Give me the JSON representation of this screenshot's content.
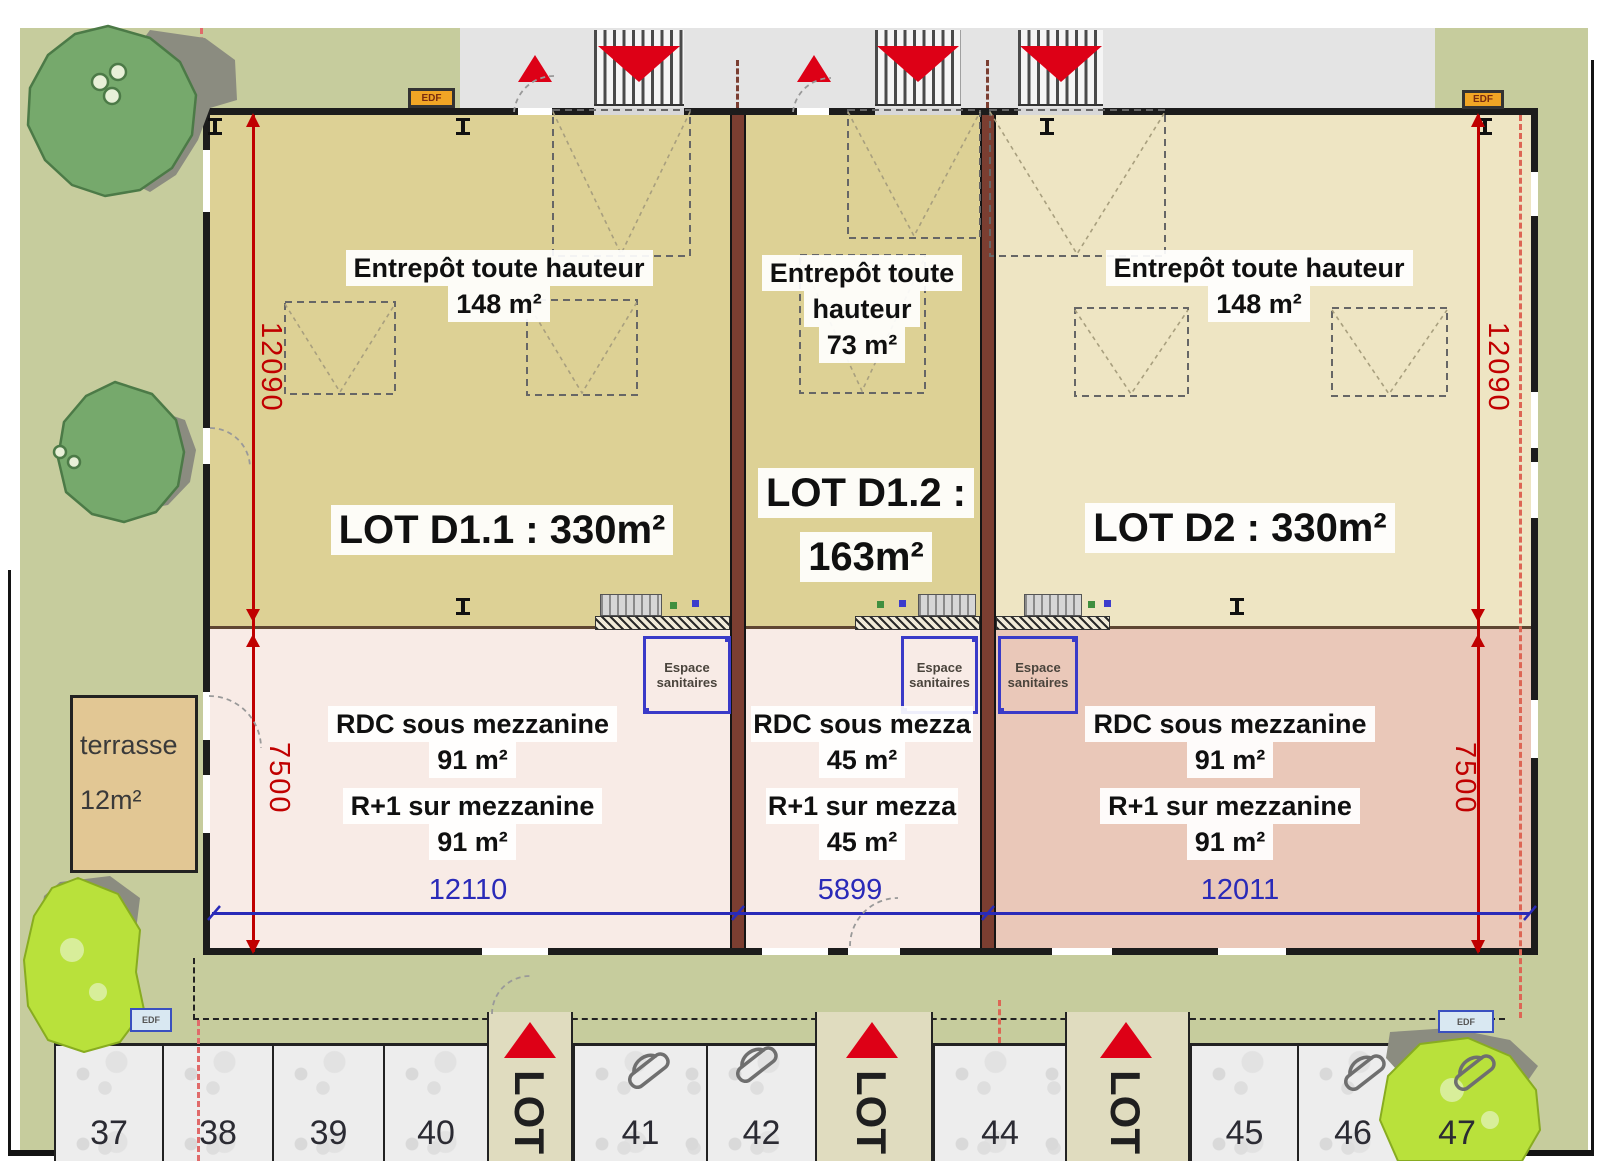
{
  "plan": {
    "units": [
      {
        "lot_label": "LOT D1.1 : 330m²",
        "entrepot_lines": [
          "Entrepôt toute hauteur",
          "148 m²"
        ],
        "rdc_label": "RDC sous mezzanine",
        "rdc_area": "91 m²",
        "r1_label": "R+1 sur mezzanine",
        "r1_area": "91 m²",
        "width_dim": "12110"
      },
      {
        "lot_label_lines": [
          "LOT D1.2 :",
          "163m²"
        ],
        "entrepot_lines": [
          "Entrepôt toute",
          "hauteur",
          "73 m²"
        ],
        "rdc_label": "RDC sous mezza",
        "rdc_area": "45 m²",
        "r1_label": "R+1 sur mezza",
        "r1_area": "45 m²",
        "width_dim": "5899"
      },
      {
        "lot_label": "LOT D2 : 330m²",
        "entrepot_lines": [
          "Entrepôt toute hauteur",
          "148 m²"
        ],
        "rdc_label": "RDC sous mezzanine",
        "rdc_area": "91 m²",
        "r1_label": "R+1 sur mezzanine",
        "r1_area": "91 m²",
        "width_dim": "12011"
      }
    ],
    "sanitaires_lines": [
      "Espace",
      "sanitaires"
    ],
    "dimensions": {
      "height_dim": "12090",
      "mezz_dim": "7500"
    },
    "terrasse_lines": [
      "terrasse",
      "12m²"
    ],
    "utility_label": "EDF",
    "walkway_label": "LOT",
    "parking_numbers": [
      "37",
      "38",
      "39",
      "40",
      "41",
      "42",
      "44",
      "45",
      "46",
      "47"
    ],
    "colors": {
      "unit_tan": "#ddd195",
      "unit_cream": "#eee5c3",
      "mezzanine_pink": "#f8ebe6",
      "mezzanine_salmon": "#eac8b9",
      "divider_wall": "#7b3e31",
      "arrow_red": "#dd0016",
      "dimension_red": "#c00000",
      "dimension_blue": "#2a2ab8",
      "site_olive": "#c6cc9d",
      "road_gray": "#e4e4e4"
    }
  }
}
